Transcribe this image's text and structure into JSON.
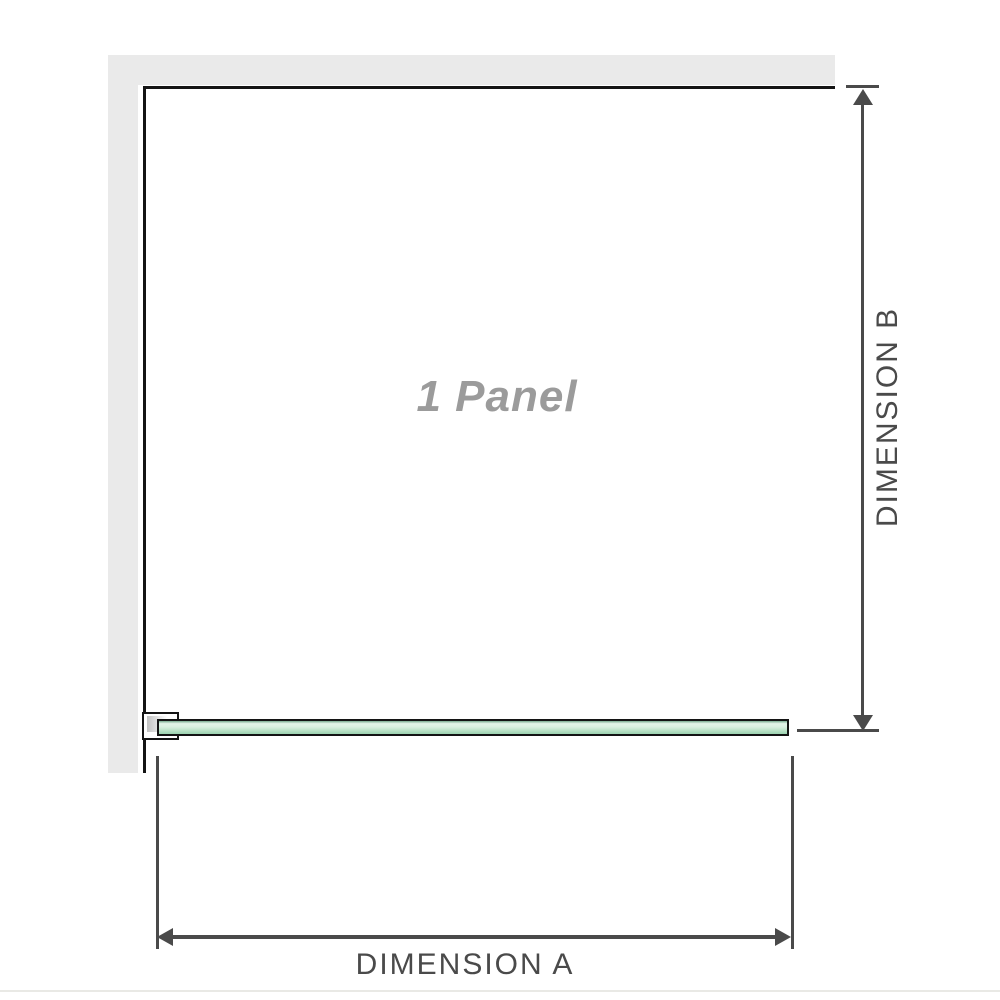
{
  "panel": {
    "label": "1 Panel"
  },
  "dimensions": {
    "a": {
      "label": "DIMENSION A"
    },
    "b": {
      "label": "DIMENSION B"
    }
  },
  "colors": {
    "wall": "#eaeaea",
    "outline": "#141414",
    "dimension_lines": "#4a4a4a",
    "glass_green_light": "#daf0e0",
    "glass_green_dark": "#9cd3b0",
    "panel_label_text": "#9b9b9b",
    "page_divider": "#e9e9e5"
  }
}
